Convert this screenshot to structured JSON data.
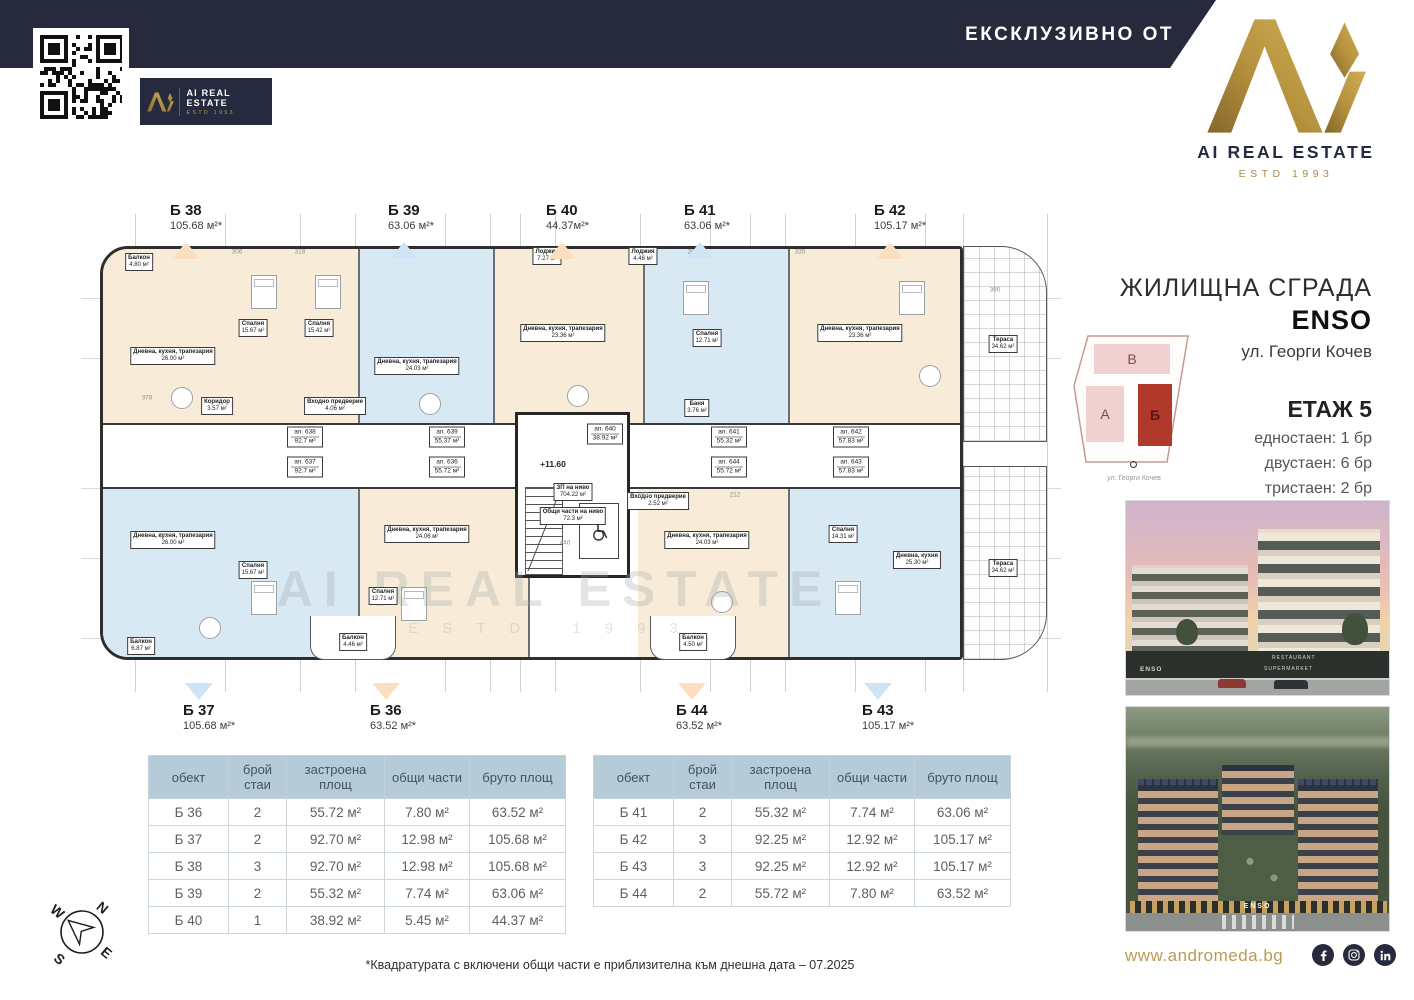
{
  "header": {
    "exclusive_label": "ЕКСКЛУЗИВНО ОТ",
    "brand_name": "AI REAL ESTATE",
    "brand_estd": "ESTD 1993"
  },
  "info": {
    "building_type": "ЖИЛИЩНА СГРАДА",
    "building_name": "ENSO",
    "address": "ул. Георги Кочев",
    "floor": "ЕТАЖ 5",
    "stats": [
      "едностаен: 1 бр",
      "двустаен: 6 бр",
      "тристаен: 2 бр"
    ]
  },
  "site_plan": {
    "blocks": {
      "top": "В",
      "left": "А",
      "highlight": "Б"
    },
    "street": "ул. Георги Кочев"
  },
  "markers": {
    "top": [
      {
        "id": "Б 38",
        "area": "105.68 м²*",
        "color": "#fbdfc0"
      },
      {
        "id": "Б 39",
        "area": "63.06 м²*",
        "color": "#cfe4f4"
      },
      {
        "id": "Б 40",
        "area": "44.37м²*",
        "color": "#fbdfc0"
      },
      {
        "id": "Б 41",
        "area": "63.06 м²*",
        "color": "#cfe4f4"
      },
      {
        "id": "Б 42",
        "area": "105.17 м²*",
        "color": "#fbdfc0"
      }
    ],
    "bottom": [
      {
        "id": "Б 37",
        "area": "105.68 м²*",
        "color": "#cfe4f4"
      },
      {
        "id": "Б 36",
        "area": "63.52 м²*",
        "color": "#fbdfc0"
      },
      {
        "id": "Б 44",
        "area": "63.52 м²*",
        "color": "#fbdfc0"
      },
      {
        "id": "Б 43",
        "area": "105.17 м²*",
        "color": "#cfe4f4"
      }
    ]
  },
  "plan": {
    "level_mark": "+11.60",
    "level_info": [
      "ЗП на ниво",
      "704.22 м²",
      "Общи части на ниво",
      "72.3 м²"
    ],
    "units": [
      {
        "id": "ап. 638",
        "area": "92.7 м²"
      },
      {
        "id": "ап. 637",
        "area": "92.7 м²"
      },
      {
        "id": "ап. 639",
        "area": "55.37 м²"
      },
      {
        "id": "ап. 636",
        "area": "55.72 м²"
      },
      {
        "id": "ап. 640",
        "area": "38.92 м²"
      },
      {
        "id": "ап. 641",
        "area": "55.32 м²"
      },
      {
        "id": "ап. 644",
        "area": "55.72 м²"
      },
      {
        "id": "ап. 642",
        "area": "57.83 м²"
      },
      {
        "id": "ап. 643",
        "area": "57.83 м²"
      }
    ],
    "rooms": [
      {
        "name": "Дневна, кухня, трапезария",
        "area": "26.00 м²"
      },
      {
        "name": "Спалня",
        "area": "15.67 м²"
      },
      {
        "name": "Спалня",
        "area": "15.42 м²"
      },
      {
        "name": "Дневна, кухня, трапезария",
        "area": "24.03 м²"
      },
      {
        "name": "Дневна, кухня, трапезария",
        "area": "23.36 м²"
      },
      {
        "name": "Спалня",
        "area": "12.71 м²"
      },
      {
        "name": "Дневна, кухня, трапезария",
        "area": "23.36 м²"
      },
      {
        "name": "Балкон",
        "area": "4.80 м²"
      },
      {
        "name": "Лоджия",
        "area": "7.27 м²"
      },
      {
        "name": "Лоджия",
        "area": "4.46 м²"
      },
      {
        "name": "Дневна, кухня, трапезария",
        "area": "26.00 м²"
      },
      {
        "name": "Спалня",
        "area": "15.67 м²"
      },
      {
        "name": "Дневна, кухня, трапезария",
        "area": "24.06 м²"
      },
      {
        "name": "Спалня",
        "area": "12.71 м²"
      },
      {
        "name": "Дневна, кухня, трапезария",
        "area": "24.03 м²"
      },
      {
        "name": "Спалня",
        "area": "14.31 м²"
      },
      {
        "name": "Дневна, кухня",
        "area": "25.30 м²"
      },
      {
        "name": "Балкон",
        "area": "6.87 м²"
      },
      {
        "name": "Балкон",
        "area": "4.46 м²"
      },
      {
        "name": "Балкон",
        "area": "4.50 м²"
      },
      {
        "name": "Тераса",
        "area": "34.62 м²"
      },
      {
        "name": "Тераса",
        "area": "34.62 м²"
      },
      {
        "name": "Баня",
        "area": "3.76 м²"
      },
      {
        "name": "Коридор",
        "area": "3.57 м²"
      },
      {
        "name": "Входно предверие",
        "area": "4.06 м²"
      },
      {
        "name": "Входно предверие",
        "area": "2.52 м²"
      }
    ],
    "dims": [
      "390",
      "378",
      "463",
      "453",
      "440",
      "306",
      "318",
      "335",
      "212",
      "200"
    ]
  },
  "tables": {
    "headers": [
      "обект",
      "брой стаи",
      "застроена площ",
      "общи части",
      "бруто площ"
    ],
    "left_rows": [
      [
        "Б 36",
        "2",
        "55.72 м²",
        "7.80 м²",
        "63.52 м²"
      ],
      [
        "Б 37",
        "2",
        "92.70 м²",
        "12.98 м²",
        "105.68 м²"
      ],
      [
        "Б 38",
        "3",
        "92.70 м²",
        "12.98 м²",
        "105.68 м²"
      ],
      [
        "Б 39",
        "2",
        "55.32 м²",
        "7.74 м²",
        "63.06 м²"
      ],
      [
        "Б 40",
        "1",
        "38.92 м²",
        "5.45 м²",
        "44.37 м²"
      ]
    ],
    "right_rows": [
      [
        "Б 41",
        "2",
        "55.32 м²",
        "7.74 м²",
        "63.06 м²"
      ],
      [
        "Б 42",
        "3",
        "92.25 м²",
        "12.92 м²",
        "105.17 м²"
      ],
      [
        "Б 43",
        "3",
        "92.25 м²",
        "12.92 м²",
        "105.17 м²"
      ],
      [
        "Б 44",
        "2",
        "55.72 м²",
        "7.80 м²",
        "63.52 м²"
      ]
    ]
  },
  "footnote": "*Квадратурата с включени общи части е приблизителна към днешна дата – 07.2025",
  "footer": {
    "website": "www.andromeda.bg",
    "socials": [
      "facebook",
      "instagram",
      "linkedin"
    ]
  },
  "compass": {
    "n": "N",
    "e": "E",
    "s": "S",
    "w": "W"
  },
  "photos": {
    "photo1_signs": [
      "RESTAURANT",
      "SUPERMARKET",
      "ENSO"
    ],
    "photo2_sign": "ENSO"
  }
}
